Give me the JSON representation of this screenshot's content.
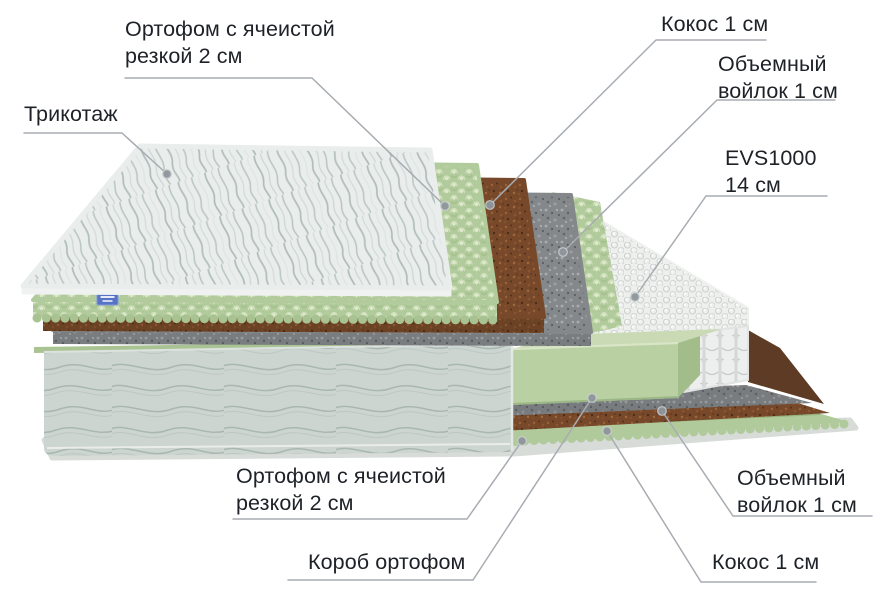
{
  "diagram": {
    "type": "mattress-layers-cutaway",
    "labels": {
      "ortofom_top": "Ортофом с ячеистой\nрезкой 2 см",
      "trikotazh": "Трикотаж",
      "kokos_top": "Кокос 1 см",
      "voilok_top": "Объемный\nвойлок 1 см",
      "evs": "EVS1000\n14 см",
      "ortofom_bottom": "Ортофом с ячеистой\nрезкой 2 см",
      "korob": "Короб ортофом",
      "voilok_bottom": "Объемный\nвойлок 1 см",
      "kokos_bottom": "Кокос 1 см"
    },
    "layers_top_to_bottom": [
      "Трикотаж",
      "Ортофом с ячеистой резкой 2 см",
      "Кокос 1 см",
      "Объемный войлок 1 см",
      "EVS1000 14 см",
      "Короб ортофом",
      "Объемный войлок 1 см",
      "Кокос 1 см",
      "Ортофом с ячеистой резкой 2 см"
    ],
    "colors": {
      "text": "#1e2227",
      "leader_line": "#a7acb1",
      "leader_dot": "#8f969c",
      "knit_top": "#e9edec",
      "foam_green": "#b2cb9c",
      "coir_brown": "#77492a",
      "felt_gray": "#84888b",
      "springs_white": "#eef0ee",
      "body_fabric": "#cdd5d1",
      "base_border": "#d8dcd9",
      "brand_tag_blue": "#5673c8"
    }
  }
}
